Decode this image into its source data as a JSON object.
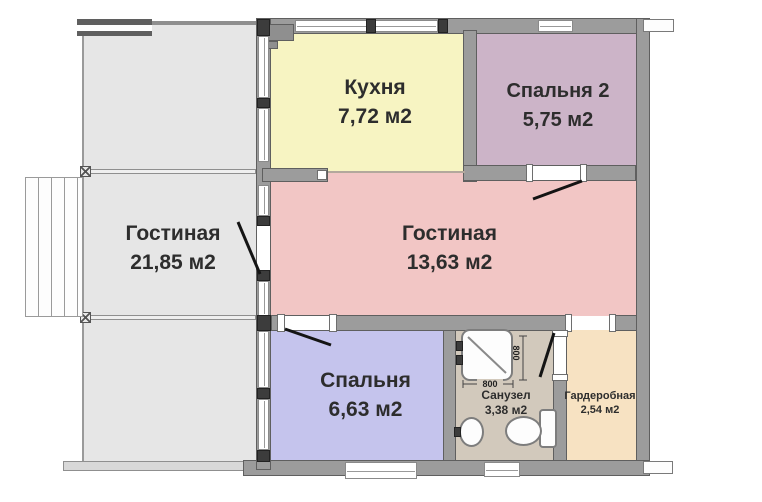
{
  "rooms": {
    "veranda": {
      "name": "Гостиная",
      "area": "21,85 м2"
    },
    "kitchen": {
      "name": "Кухня",
      "area": "7,72 м2"
    },
    "bedroom2": {
      "name": "Спальня 2",
      "area": "5,75 м2"
    },
    "living": {
      "name": "Гостиная",
      "area": "13,63 м2"
    },
    "bedroom": {
      "name": "Спальня",
      "area": "6,63 м2"
    },
    "bathroom": {
      "name": "Санузел",
      "area": "3,38 м2"
    },
    "wardrobe": {
      "name": "Гардеробная",
      "area": "2,54 м2"
    }
  },
  "dimensions": {
    "shower_width": "800",
    "shower_depth": "800"
  },
  "colors": {
    "wall": "#9c9c9c",
    "wall_edge": "#5f5f5f",
    "veranda_fill": "#e6e6e6",
    "kitchen_fill": "#f7f4c2",
    "bedroom2_fill": "#ccb4c8",
    "living_fill": "#f2c6c5",
    "bedroom_fill": "#c5c4ed",
    "bathroom_fill": "#d2c9bc",
    "wardrobe_fill": "#f7e2c2"
  }
}
